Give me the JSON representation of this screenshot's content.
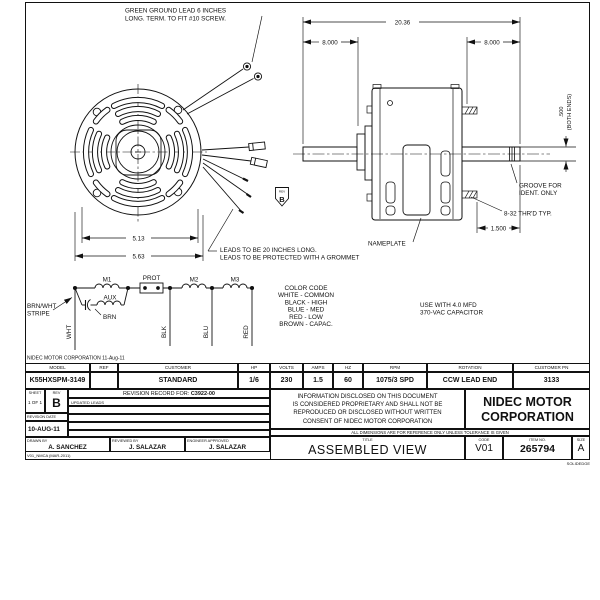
{
  "drawing": {
    "ground_note": [
      "GREEN GROUND LEAD 6 INCHES",
      "LONG. TERM. TO FIT #10 SCREW."
    ],
    "leads_note": [
      "LEADS TO BE 20 INCHES LONG.",
      "LEADS TO BE PROTECTED WITH A GROMMET"
    ],
    "nameplate_label": "NAMEPLATE",
    "groove_note": [
      "GROOVE FOR",
      "IDENT. ONLY"
    ],
    "thread_note": "8-32 THR'D TYP.",
    "rev_flag": {
      "label": "REV",
      "value": "B"
    },
    "dims": {
      "overall": "20.36",
      "left_shaft": "8.000",
      "right_shaft": "8.000",
      "shaft_dia": ".500",
      "shaft_dia_note": "(BOTH ENDS)",
      "bolt_circle": "5.13",
      "body_dia": "5.63",
      "shaft_ext": "1.500"
    },
    "capacitor_note": [
      "USE WITH 4.0 MFD",
      "370-VAC CAPACITOR"
    ]
  },
  "schematic": {
    "m1": "M1",
    "prot": "PROT",
    "m2": "M2",
    "m3": "M3",
    "aux": "AUX",
    "brn": "BRN",
    "brn_wht": [
      "BRN/WHT",
      "STRIPE"
    ],
    "wires": {
      "wht": "WHT",
      "blk": "BLK",
      "blu": "BLU",
      "red": "RED"
    },
    "color_code": {
      "title": "COLOR CODE",
      "lines": [
        "WHITE - COMMON",
        "BLACK - HIGH",
        "BLUE - MED",
        "RED - LOW",
        "BROWN - CAPAC."
      ]
    }
  },
  "footer_note": "NIDEC MOTOR CORPORATION 11-Aug-11",
  "spec_table": {
    "headers": [
      "MODEL",
      "REF",
      "CUSTOMER",
      "HP",
      "VOLTS",
      "AMPS",
      "HZ",
      "RPM",
      "ROTATION",
      "CUSTOMER PN"
    ],
    "values": [
      "K55HXSPM-3149",
      "",
      "STANDARD",
      "1/6",
      "230",
      "1.5",
      "60",
      "1075/3 SPD",
      "CCW LEAD END",
      "3133"
    ]
  },
  "revision_block": {
    "sheet_label": "SHEET",
    "sheet_value": "1 OF 1",
    "rev_label": "REV",
    "rev_value": "B",
    "record_title": "REVISION RECORD FOR:",
    "record_number": "C3922-00",
    "record_row1": "UPDATED LEADS",
    "date_label": "REVISION DATE",
    "date_value": "10-AUG-11",
    "drawn_label": "DRAWN BY",
    "drawn_value": "A. SANCHEZ",
    "reviewed_label": "REVIEWED BY",
    "reviewed_value": "J. SALAZAR",
    "approved_label": "ENGINEER APPROVED",
    "approved_value": "J. SALAZAR",
    "form_code": "V01_NMCA (MAR-2011)"
  },
  "title_block": {
    "proprietary": [
      "INFORMATION DISCLOSED ON THIS DOCUMENT",
      "IS CONSIDERED PROPRIETARY AND SHALL NOT BE",
      "REPRODUCED OR DISCLOSED WITHOUT WRITTEN",
      "CONSENT OF NIDEC MOTOR CORPORATION"
    ],
    "company": [
      "NIDEC MOTOR",
      "CORPORATION"
    ],
    "dims_note": "ALL DIMENSIONS ARE FOR REFERENCE ONLY UNLESS TOLERANCE IS GIVEN",
    "title_label": "TITLE",
    "title_value": "ASSEMBLED VIEW",
    "code_label": "CODE",
    "code_value": "V01",
    "item_label": "ITEM NO.",
    "item_value": "265794",
    "size_label": "SIZE",
    "size_value": "A",
    "cad_note": "SOLIDEDGE"
  }
}
